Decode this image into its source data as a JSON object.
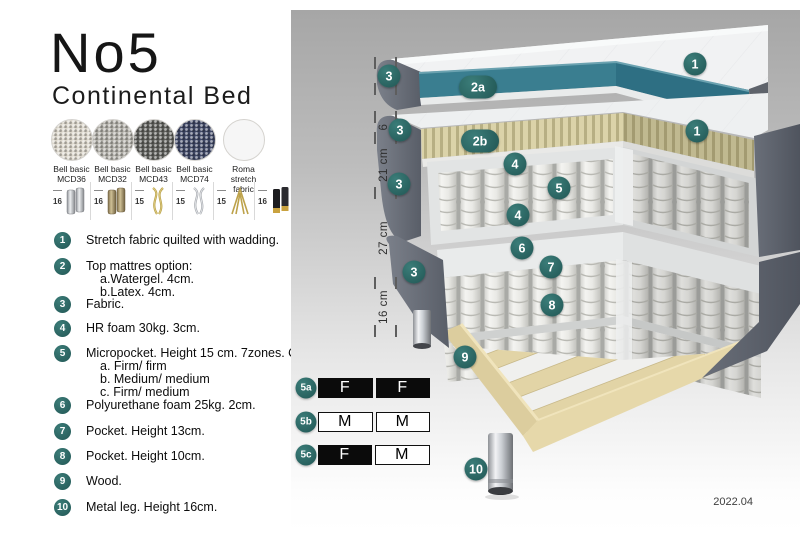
{
  "header": {
    "title": "No5",
    "subtitle": "Continental Bed"
  },
  "fabrics": [
    {
      "name": "Bell basic",
      "code": "MCD36",
      "color": "#dcd7cc"
    },
    {
      "name": "Bell basic",
      "code": "MCD32",
      "color": "#b2b0a9"
    },
    {
      "name": "Bell basic",
      "code": "MCD43",
      "color": "#5f605c"
    },
    {
      "name": "Bell basic",
      "code": "MCD74",
      "color": "#3f4765"
    },
    {
      "name": "Roma",
      "code": "stretch fabric",
      "color": "#f6f6f6"
    }
  ],
  "legs": [
    {
      "height": "16",
      "type": "cylinder-silver"
    },
    {
      "height": "16",
      "type": "cylinder-bronze"
    },
    {
      "height": "15",
      "type": "twist-gold"
    },
    {
      "height": "15",
      "type": "twist-silver"
    },
    {
      "height": "15",
      "type": "hairpin-gold"
    },
    {
      "height": "16",
      "type": "cylinder-black-gold"
    }
  ],
  "list": {
    "items": [
      {
        "num": "1",
        "text": "Stretch fabric quilted with wadding."
      },
      {
        "num": "2",
        "text": "Top mattres option:",
        "subs": [
          "a.Watergel. 4cm.",
          "b.Latex. 4cm."
        ]
      },
      {
        "num": "3",
        "text": "Fabric."
      },
      {
        "num": "4",
        "text": "HR foam 30kg. 3cm."
      },
      {
        "num": "5",
        "text": "Micropocket. Height 15 cm. 7zones. Option:",
        "subs": [
          "a. Firm/ firm",
          "b. Medium/ medium",
          "c. Firm/ medium"
        ]
      },
      {
        "num": "6",
        "text": "Polyurethane foam 25kg. 2cm."
      },
      {
        "num": "7",
        "text": "Pocket. Height 13cm."
      },
      {
        "num": "8",
        "text": "Pocket. Height 10cm."
      },
      {
        "num": "9",
        "text": "Wood."
      },
      {
        "num": "10",
        "text": "Metal leg. Height 16cm."
      }
    ]
  },
  "diagram": {
    "ruler": [
      {
        "label": "6"
      },
      {
        "label": "6"
      },
      {
        "label": "21 cm"
      },
      {
        "label": "27 cm"
      },
      {
        "label": "16 cm"
      }
    ],
    "badges": {
      "layer1": "1",
      "layer2a": "2a",
      "layer2b": "2b",
      "fabric": "3",
      "hrfoam": "4",
      "micropocket": "5",
      "pufoam": "6",
      "pocket13": "7",
      "pocket10": "8",
      "wood": "9",
      "leg": "10"
    },
    "firmness": {
      "rows": [
        {
          "id": "5a",
          "cells": [
            {
              "label": "F",
              "fill": "black"
            },
            {
              "label": "F",
              "fill": "black"
            }
          ]
        },
        {
          "id": "5b",
          "cells": [
            {
              "label": "M",
              "fill": "white"
            },
            {
              "label": "M",
              "fill": "white"
            }
          ]
        },
        {
          "id": "5c",
          "cells": [
            {
              "label": "F",
              "fill": "black"
            },
            {
              "label": "M",
              "fill": "white"
            }
          ]
        }
      ]
    },
    "version": "2022.04"
  },
  "colors": {
    "badge_teal": "#2e6b69",
    "watergel_teal": "#38798c",
    "latex_beige": "#d9d2a8",
    "fabric_gray": "#676c74",
    "wood": "#e0d2a4",
    "panel_gradient_top": "#a6a6a6",
    "panel_gradient_bottom": "#ffffff"
  }
}
